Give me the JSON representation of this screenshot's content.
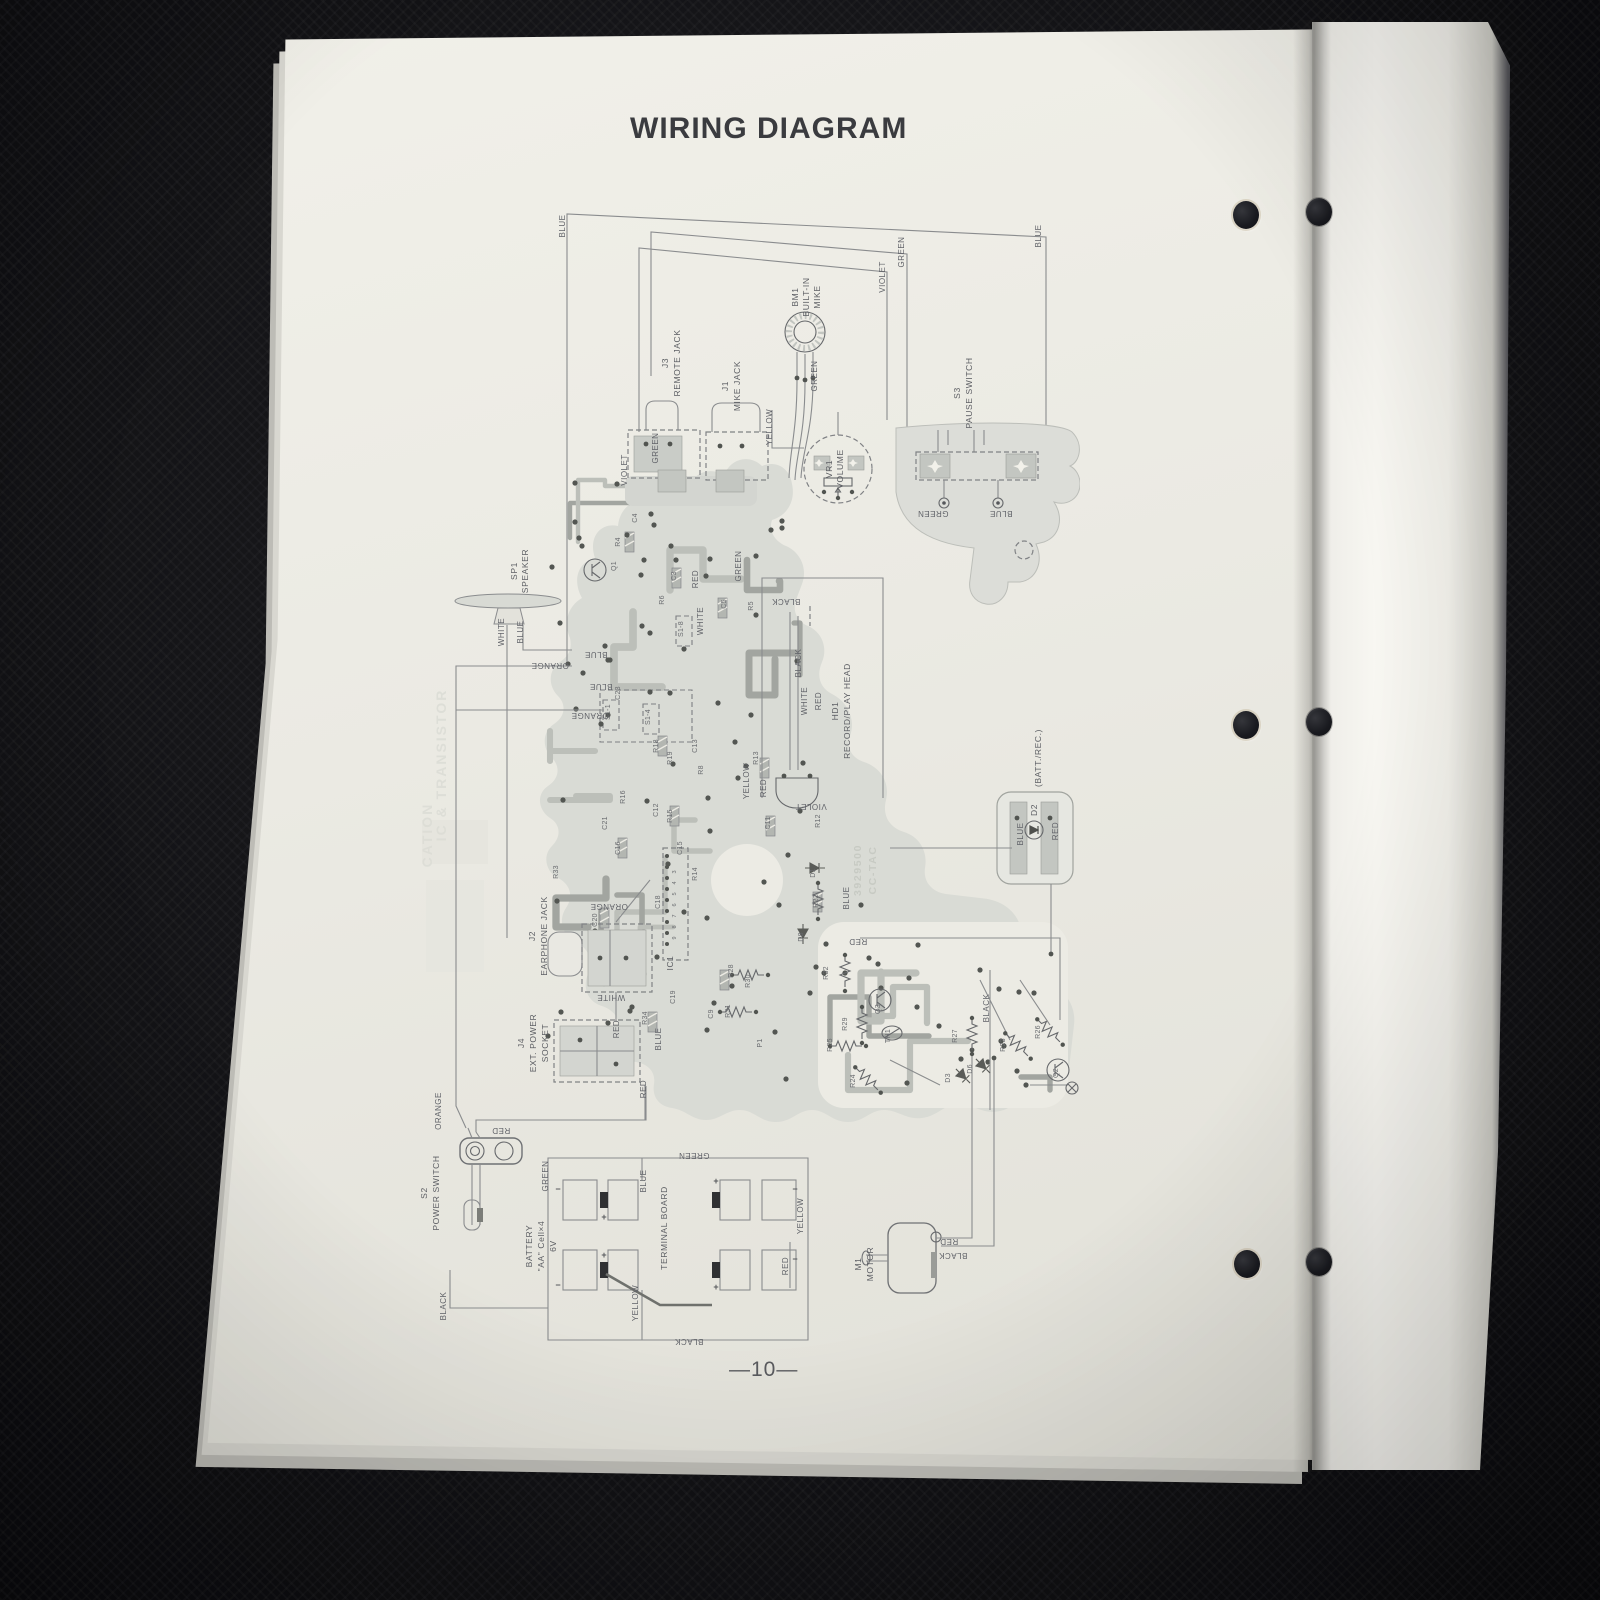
{
  "scene": {
    "background_color": "#141417",
    "left_page_color": "#ecebe4",
    "right_page_color": "#f6f5f0",
    "diagram_line_color": "#8a8c8e",
    "pcb_fill_color": "#d9dbd5",
    "hole_count_per_page": 3
  },
  "page": {
    "title": "WIRING DIAGRAM",
    "page_number": "—10—"
  },
  "diagram": {
    "components": [
      {
        "id": "J3",
        "name": "REMOTE JACK"
      },
      {
        "id": "J1",
        "name": "MIKE JACK"
      },
      {
        "id": "BM1",
        "name": "BUILT-IN MIKE"
      },
      {
        "id": "S3",
        "name": "PAUSE SWITCH"
      },
      {
        "id": "VR1",
        "name": "VOLUME"
      },
      {
        "id": "SP1",
        "name": "SPEAKER"
      },
      {
        "id": "HD1",
        "name": "RECORD/PLAY HEAD"
      },
      {
        "id": "J2",
        "name": "EARPHONE JACK"
      },
      {
        "id": "J4",
        "name": "EXT. POWER SOCKET"
      },
      {
        "id": "S2",
        "name": "POWER SWITCH"
      },
      {
        "id": "BATTERY",
        "name": "\"AA\" Cell×4 6V"
      },
      {
        "id": "TB",
        "name": "TERMINAL BOARD"
      },
      {
        "id": "M1",
        "name": "MOTOR"
      },
      {
        "id": "D2",
        "name": "(BATT./REC.) LED"
      },
      {
        "id": "IC1",
        "name": "IC"
      }
    ],
    "board_marking": "3929500 CC-TAC",
    "wire_colors": [
      "BLUE",
      "GREEN",
      "VIOLET",
      "YELLOW",
      "ORANGE",
      "WHITE",
      "RED",
      "BLACK"
    ],
    "labels": [
      [
        "J3",
        248,
        183,
        -90,
        "c"
      ],
      [
        "REMOTE JACK",
        260,
        183,
        -90,
        "c"
      ],
      [
        "J1",
        308,
        206,
        -90,
        "c"
      ],
      [
        "MIKE JACK",
        320,
        206,
        -90,
        "c"
      ],
      [
        "BM1",
        378,
        117,
        -90,
        "c"
      ],
      [
        "BUILT-IN",
        389,
        117,
        -90,
        "c"
      ],
      [
        "MIKE",
        400,
        117,
        -90,
        "c"
      ],
      [
        "S3",
        540,
        213,
        -90,
        "c"
      ],
      [
        "PAUSE SWITCH",
        552,
        213,
        -90,
        "c"
      ],
      [
        "VR1",
        412,
        289,
        -90,
        "c"
      ],
      [
        "VOLUME",
        423,
        289,
        -90,
        "c"
      ],
      [
        "SP1",
        97,
        391,
        -90,
        "c"
      ],
      [
        "SPEAKER",
        108,
        391,
        -90,
        "c"
      ],
      [
        "HD1",
        418,
        531,
        -90,
        "c"
      ],
      [
        "RECORD/PLAY HEAD",
        430,
        531,
        -90,
        "c"
      ],
      [
        "J2",
        115,
        756,
        -90,
        "c"
      ],
      [
        "EARPHONE JACK",
        127,
        756,
        -90,
        "c"
      ],
      [
        "J4",
        104,
        863,
        -90,
        "c"
      ],
      [
        "EXT. POWER",
        116,
        863,
        -90,
        "c"
      ],
      [
        "SOCKET",
        128,
        863,
        -90,
        "c"
      ],
      [
        "S2",
        7,
        1013,
        -90,
        "c"
      ],
      [
        "POWER SWITCH",
        19,
        1013,
        -90,
        "c"
      ],
      [
        "BATTERY",
        112,
        1066,
        -90,
        "c"
      ],
      [
        "\"AA\" Cell×4",
        124,
        1066,
        -90,
        "c"
      ],
      [
        "6V",
        136,
        1066,
        -90,
        "c"
      ],
      [
        "TERMINAL BOARD",
        247,
        1048,
        -90,
        "c"
      ],
      [
        "M1",
        441,
        1084,
        -90,
        "c"
      ],
      [
        "MOTOR",
        453,
        1084,
        -90,
        "c"
      ],
      [
        "D2",
        617,
        630,
        -90,
        "c"
      ],
      [
        "(BATT./REC.)",
        621,
        578,
        -90,
        "c"
      ],
      [
        "IC1",
        253,
        783,
        -90,
        "c"
      ],
      [
        "3929500",
        441,
        690,
        -90,
        "m"
      ],
      [
        "CC-TAC",
        456,
        690,
        -90,
        "m"
      ],
      [
        "BLUE",
        145,
        46,
        -90,
        "l"
      ],
      [
        "GREEN",
        484,
        72,
        -90,
        "l"
      ],
      [
        "VIOLET",
        465,
        97,
        -90,
        "l"
      ],
      [
        "BLUE",
        621,
        56,
        -90,
        "l"
      ],
      [
        "GREEN",
        238,
        268,
        -90,
        "l"
      ],
      [
        "VIOLET",
        207,
        290,
        -90,
        "l"
      ],
      [
        "GREEN",
        397,
        196,
        -90,
        "l"
      ],
      [
        "YELLOW",
        352,
        247,
        -90,
        "l"
      ],
      [
        "GREEN",
        513,
        331,
        180,
        "l"
      ],
      [
        "BLUE",
        581,
        331,
        180,
        "l"
      ],
      [
        "WHITE",
        84,
        452,
        -90,
        "l"
      ],
      [
        "BLUE",
        103,
        452,
        -90,
        "l"
      ],
      [
        "ORANGE",
        130,
        483,
        180,
        "l"
      ],
      [
        "BLUE",
        176,
        472,
        180,
        "l"
      ],
      [
        "BLUE",
        181,
        504,
        180,
        "l"
      ],
      [
        "ORANGE",
        170,
        533,
        180,
        "l"
      ],
      [
        "BLACK",
        366,
        419,
        180,
        "l"
      ],
      [
        "BLACK",
        381,
        483,
        -90,
        "l"
      ],
      [
        "WHITE",
        387,
        521,
        -90,
        "l"
      ],
      [
        "RED",
        401,
        521,
        -90,
        "l"
      ],
      [
        "VIOLET",
        391,
        624,
        180,
        "l"
      ],
      [
        "RED",
        438,
        759,
        180,
        "l"
      ],
      [
        "GREEN",
        321,
        386,
        -90,
        "l"
      ],
      [
        "RED",
        278,
        399,
        -90,
        "l"
      ],
      [
        "WHITE",
        283,
        441,
        -90,
        "l"
      ],
      [
        "YELLOW",
        329,
        601,
        -90,
        "l"
      ],
      [
        "RED",
        346,
        608,
        -90,
        "l"
      ],
      [
        "BLUE",
        603,
        654,
        -90,
        "l"
      ],
      [
        "RED",
        638,
        651,
        -90,
        "l"
      ],
      [
        "ORANGE",
        189,
        724,
        180,
        "l"
      ],
      [
        "WHITE",
        191,
        815,
        180,
        "l"
      ],
      [
        "RED",
        199,
        849,
        -90,
        "l"
      ],
      [
        "BLUE",
        241,
        859,
        -90,
        "l"
      ],
      [
        "RED",
        226,
        909,
        -90,
        "l"
      ],
      [
        "BLUE",
        429,
        718,
        -90,
        "l"
      ],
      [
        "RED",
        81,
        948,
        180,
        "l"
      ],
      [
        "ORANGE",
        21,
        931,
        -90,
        "l"
      ],
      [
        "GREEN",
        128,
        996,
        -90,
        "l"
      ],
      [
        "BLUE",
        226,
        1001,
        -90,
        "l"
      ],
      [
        "GREEN",
        274,
        973,
        180,
        "l"
      ],
      [
        "YELLOW",
        383,
        1036,
        -90,
        "l"
      ],
      [
        "RED",
        368,
        1086,
        -90,
        "l"
      ],
      [
        "YELLOW",
        218,
        1123,
        -90,
        "l"
      ],
      [
        "BLACK",
        26,
        1126,
        -90,
        "l"
      ],
      [
        "BLACK",
        269,
        1159,
        180,
        "l"
      ],
      [
        "RED",
        529,
        1059,
        180,
        "l"
      ],
      [
        "BLACK",
        533,
        1073,
        180,
        "l"
      ],
      [
        "BLACK",
        569,
        828,
        -90,
        "l"
      ],
      [
        "R4",
        200,
        362,
        -90,
        "r"
      ],
      [
        "Q1",
        196,
        386,
        -90,
        "r"
      ],
      [
        "C4",
        217,
        338,
        -90,
        "r"
      ],
      [
        "C3",
        256,
        396,
        -90,
        "r"
      ],
      [
        "R6",
        244,
        420,
        -90,
        "r"
      ],
      [
        "C5",
        306,
        424,
        -90,
        "r"
      ],
      [
        "R5",
        333,
        426,
        -90,
        "r"
      ],
      [
        "C23",
        200,
        513,
        -90,
        "r"
      ],
      [
        "S1-1",
        190,
        532,
        -90,
        "r"
      ],
      [
        "S1-4",
        230,
        537,
        -90,
        "r"
      ],
      [
        "S1-8",
        263,
        449,
        -90,
        "r"
      ],
      [
        "R18",
        238,
        566,
        -90,
        "r"
      ],
      [
        "R19",
        252,
        578,
        -90,
        "r"
      ],
      [
        "C13",
        277,
        566,
        -90,
        "r"
      ],
      [
        "R8",
        283,
        590,
        -90,
        "r"
      ],
      [
        "R16",
        205,
        617,
        -90,
        "r"
      ],
      [
        "C12",
        238,
        630,
        -90,
        "r"
      ],
      [
        "R15",
        252,
        636,
        -90,
        "r"
      ],
      [
        "C21",
        187,
        643,
        -90,
        "r"
      ],
      [
        "C16",
        200,
        668,
        -90,
        "r"
      ],
      [
        "C15",
        262,
        668,
        -90,
        "r"
      ],
      [
        "R13",
        338,
        578,
        -90,
        "r"
      ],
      [
        "C11",
        350,
        643,
        -90,
        "r"
      ],
      [
        "R12",
        400,
        641,
        -90,
        "r"
      ],
      [
        "D1",
        395,
        693,
        -90,
        "r"
      ],
      [
        "R22",
        398,
        721,
        -90,
        "r"
      ],
      [
        "D8",
        383,
        757,
        -90,
        "r"
      ],
      [
        "C18",
        240,
        722,
        -90,
        "r"
      ],
      [
        "C20",
        177,
        740,
        -90,
        "r"
      ],
      [
        "C19",
        255,
        817,
        -90,
        "r"
      ],
      [
        "R34",
        227,
        838,
        -90,
        "r"
      ],
      [
        "R33",
        138,
        692,
        -90,
        "r"
      ],
      [
        "R14",
        277,
        694,
        -90,
        "r"
      ],
      [
        "C9",
        293,
        834,
        -90,
        "r"
      ],
      [
        "R28",
        313,
        791,
        -90,
        "r"
      ],
      [
        "R30",
        330,
        801,
        -90,
        "r"
      ],
      [
        "R31",
        310,
        831,
        -90,
        "r"
      ],
      [
        "P1",
        342,
        863,
        -90,
        "r"
      ],
      [
        "R24",
        435,
        901,
        -90,
        "r"
      ],
      [
        "R25",
        412,
        865,
        -90,
        "r"
      ],
      [
        "R29",
        427,
        844,
        -90,
        "r"
      ],
      [
        "R32",
        408,
        793,
        -90,
        "r"
      ],
      [
        "Q3",
        460,
        829,
        -90,
        "r"
      ],
      [
        "TH1",
        470,
        856,
        -90,
        "r"
      ],
      [
        "R27",
        537,
        856,
        -90,
        "r"
      ],
      [
        "D3",
        530,
        898,
        -90,
        "r"
      ],
      [
        "D6",
        552,
        889,
        -90,
        "r"
      ],
      [
        "R23",
        585,
        865,
        -90,
        "r"
      ],
      [
        "R26",
        620,
        852,
        -90,
        "r"
      ],
      [
        "Q2",
        638,
        893,
        -90,
        "r"
      ],
      [
        "3",
        256,
        692,
        -90,
        "p"
      ],
      [
        "4",
        256,
        703,
        -90,
        "p"
      ],
      [
        "5",
        256,
        714,
        -90,
        "p"
      ],
      [
        "6",
        256,
        725,
        -90,
        "p"
      ],
      [
        "7",
        256,
        736,
        -90,
        "p"
      ],
      [
        "8",
        256,
        747,
        -90,
        "p"
      ],
      [
        "9",
        256,
        758,
        -90,
        "p"
      ],
      [
        "−",
        138,
        1012,
        0,
        "pol"
      ],
      [
        "+",
        184,
        1040,
        0,
        "pol"
      ],
      [
        "+",
        296,
        1004,
        0,
        "pol"
      ],
      [
        "−",
        375,
        1012,
        0,
        "pol"
      ],
      [
        "+",
        184,
        1078,
        0,
        "pol"
      ],
      [
        "−",
        138,
        1108,
        0,
        "pol"
      ],
      [
        "+",
        296,
        1110,
        0,
        "pol"
      ],
      [
        "−",
        375,
        1082,
        0,
        "pol"
      ],
      [
        "IC & TRANSISTOR",
        26,
        585,
        -90,
        "g"
      ],
      [
        "CATION",
        12,
        655,
        -90,
        "g"
      ]
    ]
  }
}
